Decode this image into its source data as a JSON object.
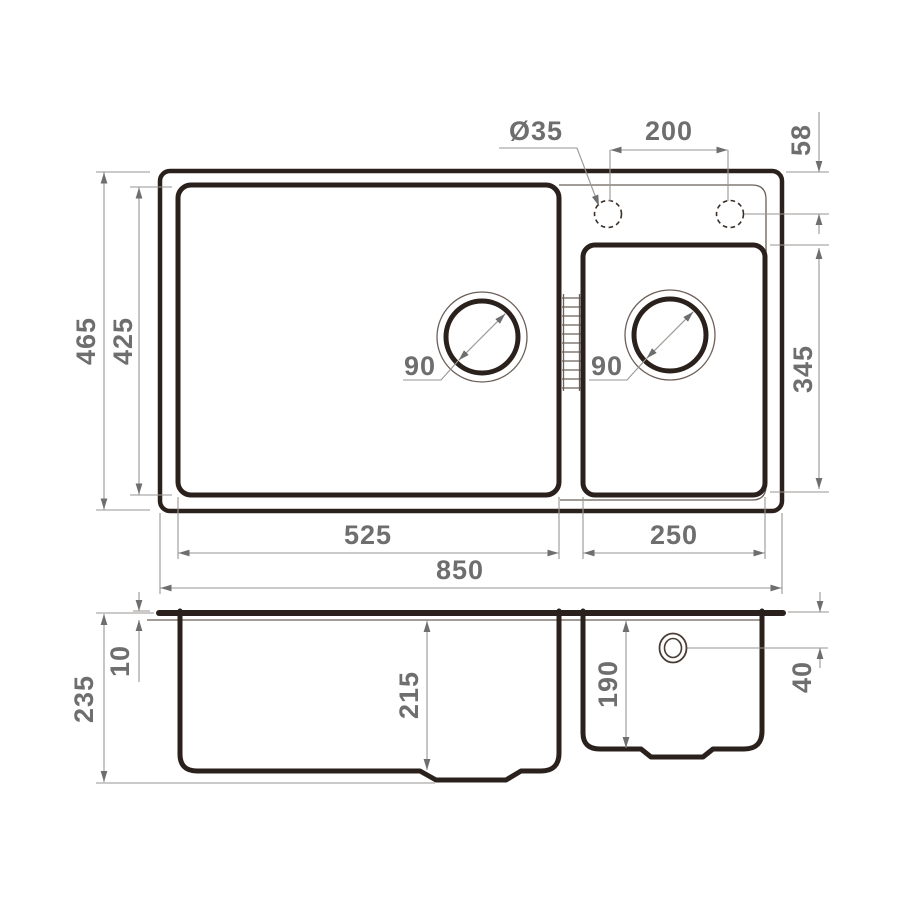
{
  "title": "sink-technical-drawing",
  "colors": {
    "outline": "#2b211c",
    "thin_line": "#6b5f57",
    "dimension_line": "#9a9691",
    "dimension_text": "#6e6e6e",
    "background": "#ffffff"
  },
  "dims": {
    "faucet_hole_diameter": "Ø35",
    "faucet_hole_spacing": "200",
    "faucet_hole_edge_offset": "58",
    "overall_depth": "465",
    "main_bowl_depth": "425",
    "small_bowl_depth_plan": "345",
    "main_drain_diameter": "90",
    "small_drain_diameter": "90",
    "main_bowl_width": "525",
    "small_bowl_width": "250",
    "overall_width": "850",
    "overall_height": "235",
    "rim_thickness": "10",
    "main_bowl_inner_height": "215",
    "small_bowl_inner_height": "190",
    "overflow_offset": "40"
  }
}
